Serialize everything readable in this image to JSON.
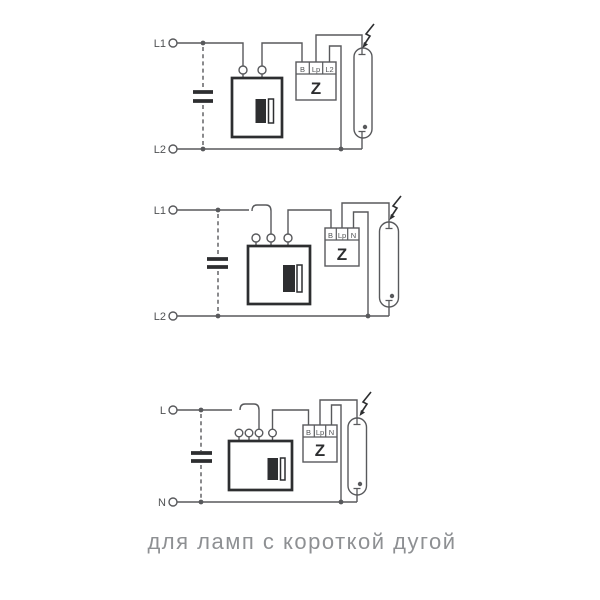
{
  "caption": {
    "text": "для ламп с короткой дугой"
  },
  "colors": {
    "wire": "#58595c",
    "component": "#2d2e30",
    "label": "#505254",
    "captiontext": "#8e9093",
    "background": "#ffffff"
  },
  "icons": {
    "high_voltage_pulse": "lightning-bolt",
    "capacitor": "parallel-plates",
    "jumper": "removable-link-bracket",
    "lamp": "tubular-discharge-lamp"
  },
  "circuits": [
    {
      "position": "top",
      "supply": {
        "top": "L1",
        "bottom": "L2"
      },
      "capacitor": true,
      "ballast": {
        "terminals": 2,
        "jumper": false
      },
      "ignitor": {
        "label": "Z",
        "terminals": [
          "B",
          "Lp",
          "L2"
        ]
      },
      "lamp": {
        "high_voltage_pulse": true
      }
    },
    {
      "position": "middle",
      "supply": {
        "top": "L1",
        "bottom": "L2"
      },
      "capacitor": true,
      "ballast": {
        "terminals": 3,
        "jumper": true
      },
      "ignitor": {
        "label": "Z",
        "terminals": [
          "B",
          "Lp",
          "N"
        ]
      },
      "lamp": {
        "high_voltage_pulse": true
      }
    },
    {
      "position": "bottom",
      "supply": {
        "top": "L",
        "bottom": "N"
      },
      "capacitor": true,
      "ballast": {
        "terminals": 4,
        "jumper": true
      },
      "ignitor": {
        "label": "Z",
        "terminals": [
          "B",
          "Lp",
          "N"
        ]
      },
      "lamp": {
        "high_voltage_pulse": true
      }
    }
  ]
}
